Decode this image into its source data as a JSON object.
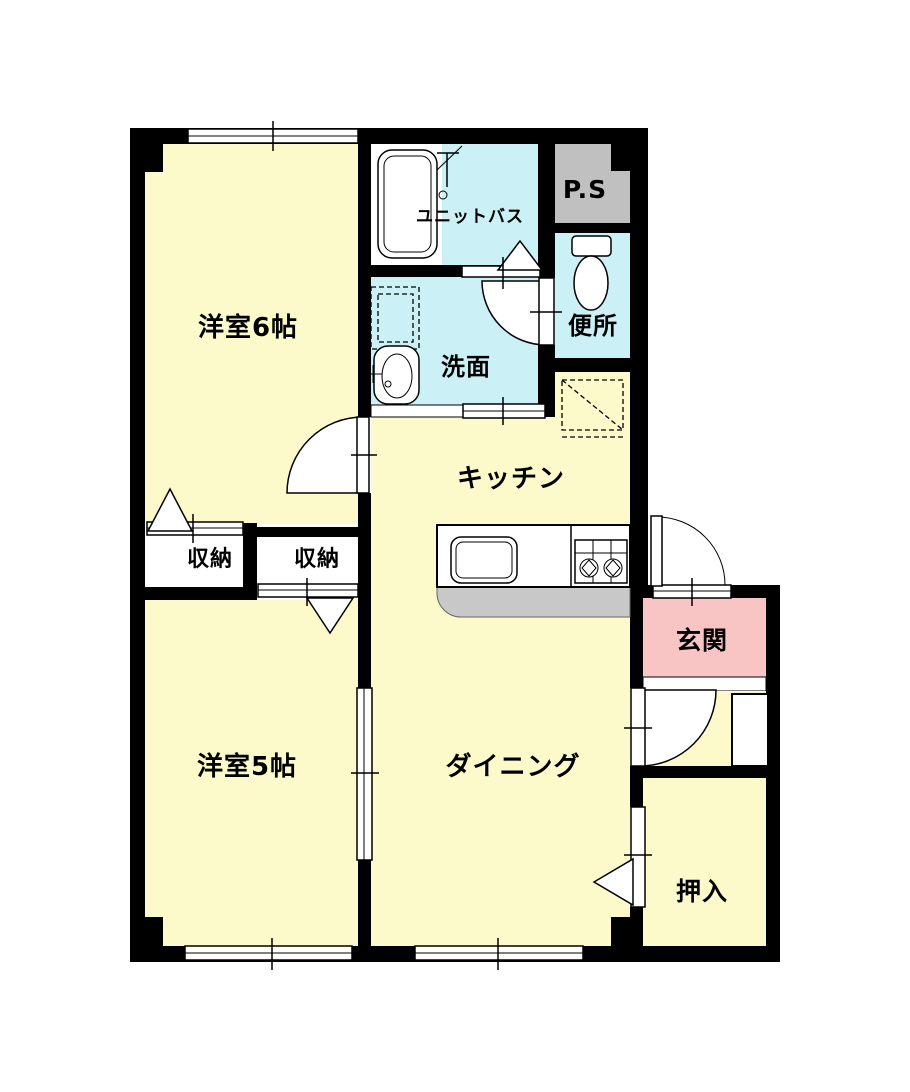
{
  "labels": {
    "western6": "洋室6帖",
    "western5": "洋室5帖",
    "kitchen": "キッチン",
    "dining": "ダイニング",
    "entrance": "玄関",
    "oshiire": "押入",
    "storage_left": "収納",
    "storage_right": "収納",
    "washroom": "洗面",
    "toilet": "便所",
    "unit_bath": "ユニットバス",
    "pipe_space": "P.S"
  },
  "colors": {
    "room_fill": "#FCFACA",
    "wet_fill": "#CBF0F5",
    "entrance_fill": "#F9C4C4",
    "ps_fill": "#C0C0C0",
    "counter_fill": "#C8C8C8",
    "wall": "#000000"
  }
}
